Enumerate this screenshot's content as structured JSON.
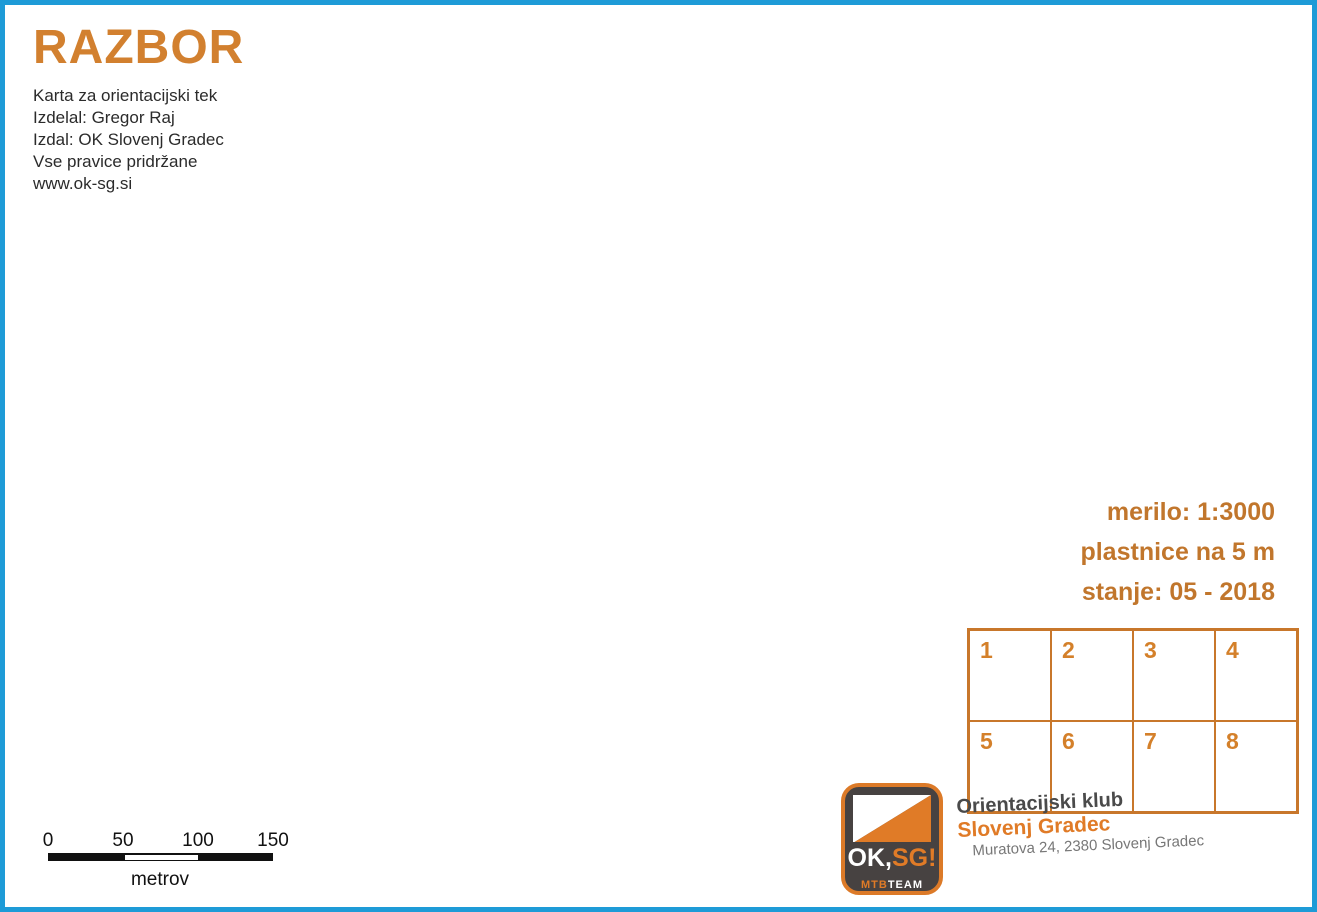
{
  "title_block": {
    "title": "RAZBOR",
    "lines": [
      "Karta za orientacijski tek",
      "Izdelal: Gregor Raj",
      "Izdal: OK Slovenj Gradec",
      "Vse pravice pridržane",
      "www.ok-sg.si"
    ]
  },
  "map_info": {
    "scale_label": "merilo: 1:3000",
    "contour_label": "plastnice na 5 m",
    "status_label": "stanje: 05 - 2018"
  },
  "control_card": {
    "cells": [
      "1",
      "2",
      "3",
      "4",
      "5",
      "6",
      "7",
      "8"
    ]
  },
  "club": {
    "name_line1": "Orientacijski klub",
    "name_line2": "Slovenj Gradec",
    "address": "Muratova 24, 2380 Slovenj Gradec",
    "logo_ok": "OK,",
    "logo_sg": "SG!",
    "logo_mtb": "MTB",
    "logo_team": "TEAM"
  },
  "scale_bar": {
    "ticks": [
      "0",
      "50",
      "100",
      "150"
    ],
    "unit": "metrov"
  },
  "watermark": {
    "line1": "ORIENTACIJSKA ZVEZA",
    "line2": "SLOVENIJE"
  },
  "symbols": {
    "t_label": "T",
    "north_letter": "N"
  },
  "colors": {
    "open_land": "#F9BC59",
    "contour": "#B77330",
    "contour_index": "#A5661F",
    "road_fill": "#EDCBA0",
    "road_casing": "#A66F26",
    "building_gray": "#7F8486",
    "building_outline": "#33383A",
    "olive_green": "#97A62B",
    "tree_green": "#3DAE49",
    "water_blue": "#3FA9E8",
    "north_line": "#2AA7DC",
    "frame_blue": "#1E9BD7",
    "accent_orange": "#D4802A",
    "title_orange": "#D2802F",
    "club_orange": "#E07B27",
    "watermark_gray": "#C2C2C2",
    "black": "#1A1A1A"
  }
}
